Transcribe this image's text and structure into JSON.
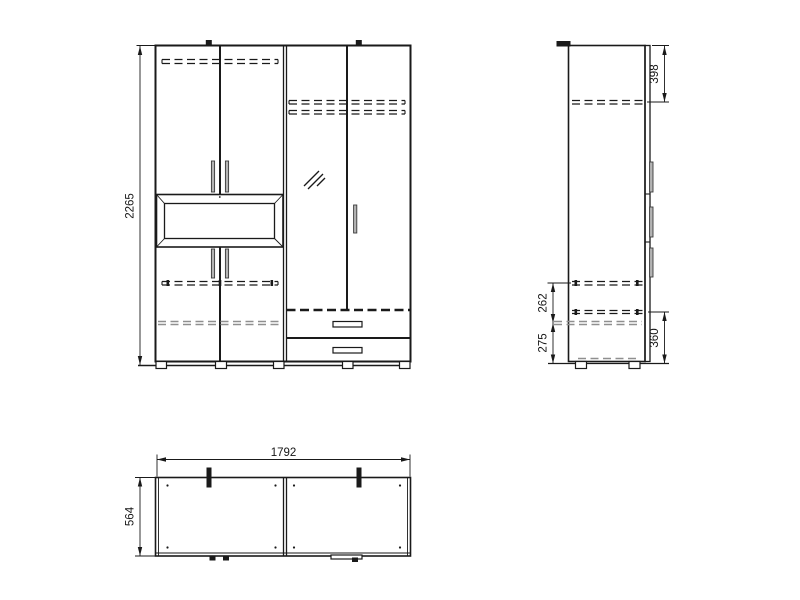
{
  "drawing": {
    "colors": {
      "line": "#1a1a1a",
      "dashed_gray": "#8f8f8f",
      "handle_fill": "#b4b4b4",
      "background": "#ffffff"
    },
    "dimensions": {
      "front_height": "2265",
      "side_top_shelf": "398",
      "side_shelf_gap": "262",
      "side_bottom_section": "275",
      "side_drawer_section": "360",
      "plan_width": "1792",
      "plan_depth": "564"
    }
  }
}
